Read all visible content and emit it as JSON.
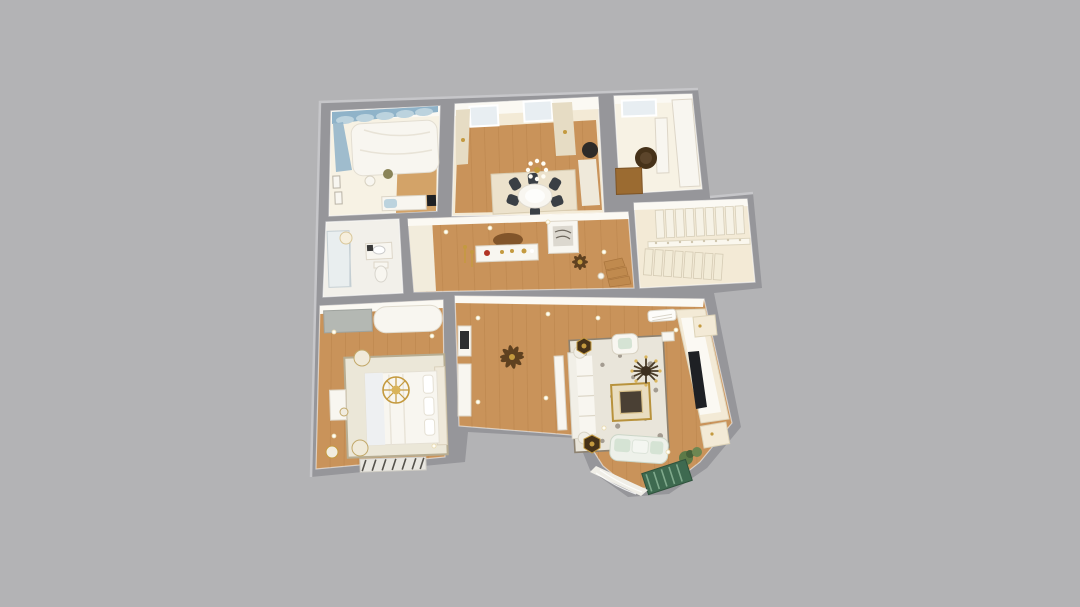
{
  "scene": {
    "description": "Photoreal 3D dollhouse top-down render of a single-storey apartment floor plan centered on a plain gray background",
    "background": "plain flat gray, no text or UI controls visible",
    "rooms": [
      {
        "id": "bedroom-top-left",
        "furniture": [
          "white canopy bed with blue swag drapery",
          "framed wall art",
          "plant",
          "white dresser with small tv",
          "light-blue stool"
        ]
      },
      {
        "id": "dining-room",
        "furniture": [
          "round white dining table",
          "dark upholstered chairs",
          "globe chandelier",
          "two windows with cream curtains",
          "light area rug",
          "dark floor lamp",
          "cream cabinet"
        ]
      },
      {
        "id": "study",
        "furniture": [
          "dark round armchair",
          "white desk",
          "built-in white cabinets",
          "wood cabinet",
          "window"
        ]
      },
      {
        "id": "stair-hall",
        "furniture": [
          "switchback staircase with white railing and balusters"
        ]
      },
      {
        "id": "bathroom",
        "furniture": [
          "glass shower enclosure",
          "vanity with sink",
          "toilet",
          "round ceiling light"
        ]
      },
      {
        "id": "hallway",
        "furniture": [
          "white console table with red and gold vases",
          "arched brown wall shelf",
          "artwork panel",
          "small ceiling fan",
          "gold floor candlesticks",
          "wood lower stair steps"
        ]
      },
      {
        "id": "master-bedroom",
        "furniture": [
          "large white bed",
          "ornate gold chandelier",
          "two round nightstands",
          "light area rug",
          "gray wardrobe",
          "white chaise",
          "vanity with stool",
          "dark striped bench"
        ]
      },
      {
        "id": "family-area",
        "furniture": [
          "dark wood ceiling fan",
          "white media cabinet with dark panel",
          "tall white cabinet"
        ]
      },
      {
        "id": "living-room",
        "furniture": [
          "white sectional sofa",
          "sage loveseat",
          "cream armchair",
          "gold-framed coffee table",
          "gray patterned rug",
          "white tv wall unit with dark tv",
          "spider-arm chandelier",
          "air conditioner",
          "two dark hexagonal side tables",
          "green plants"
        ]
      },
      {
        "id": "bay-window",
        "furniture": [
          "green striped lounge mat",
          "sheer white curtain",
          "small plant"
        ]
      }
    ]
  },
  "colors": {
    "background": "#b3b3b5",
    "wall": "#96969a",
    "wallHighlight": "#c6c6c9",
    "cream": "#f3ead6",
    "creamBright": "#f7f2e4",
    "ceilingWhite": "#fbf9f3",
    "white": "#f8f6f0",
    "whiteStroke": "#ddd6c8",
    "wood": "#c9935a",
    "woodDark": "#a9753d",
    "woodLight": "#d3a368",
    "tile": "#f2f0ea",
    "rug": "#e9e5da",
    "rugBorder": "#8d8271",
    "rugPattern": "#6a6054",
    "bedroomRug": "#ebe7d8",
    "bedroomRugBorder": "#b7ad92",
    "diningRug": "#ece2cc",
    "blue": "#8fb3c9",
    "blueLight": "#bcd3de",
    "windowGlass": "#e8eef2",
    "chairDark": "#3a3f45",
    "dark": "#1e2024",
    "espresso": "#463219",
    "gold": "#c49a3f",
    "goldLight": "#d9b45c",
    "brown": "#82552a",
    "brownMid": "#9b6b31",
    "green": "#3e6a50",
    "greenStripe": "#7fa98c",
    "sage": "#d5e3d4",
    "plant": "#5d7a48",
    "olive": "#8a8458",
    "red": "#b23424",
    "grayFurniture": "#b4b8b3",
    "fanBrown": "#5f4120",
    "downlight": "#fffdf5"
  }
}
